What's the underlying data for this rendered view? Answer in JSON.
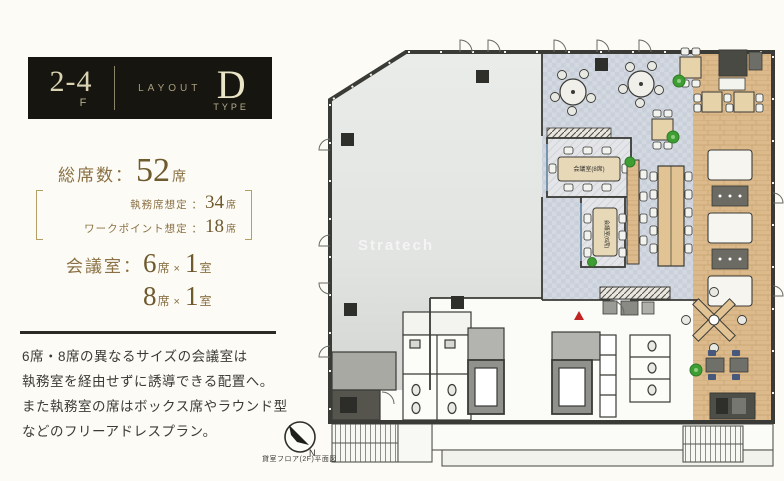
{
  "header": {
    "floor": "2-4",
    "floor_suffix": "F",
    "layout_label": "LAYOUT",
    "layout_letter": "D",
    "layout_type": "TYPE"
  },
  "totals": {
    "label": "総席数：",
    "value": "52",
    "unit": "席",
    "breakdown": [
      {
        "label": "執務席想定 ：",
        "value": "34",
        "unit": "席"
      },
      {
        "label": "ワークポイント想定 ：",
        "value": "18",
        "unit": "席"
      }
    ]
  },
  "meeting": {
    "label": "会議室：",
    "rows": [
      {
        "seats": "6",
        "seat_unit": "席",
        "times": "×",
        "count": "1",
        "room_unit": "室"
      },
      {
        "seats": "8",
        "seat_unit": "席",
        "times": "×",
        "count": "1",
        "room_unit": "室"
      }
    ]
  },
  "description": {
    "line1": "6席・8席の異なるサイズの会議室は",
    "line2": "執務室を経由せずに誘導できる配置へ。",
    "line3": "また執務室の席はボックス席やラウンド型",
    "line4": "などのフリーアドレスプラン。"
  },
  "plan": {
    "watermark": "Stratech",
    "room8_label": "会議室(8席)",
    "room6_label": "会議室(6席)",
    "north_label": "N",
    "caption": "貸室フロア(2F)平面図"
  },
  "colors": {
    "accent_gold": "#8a7044",
    "header_bg": "#17150f",
    "wall": "#3a3a36",
    "carpet": "#d2d7e0",
    "wood": "#dcba8c",
    "plant_green": "#3f9e33",
    "alert_red": "#c32222"
  }
}
